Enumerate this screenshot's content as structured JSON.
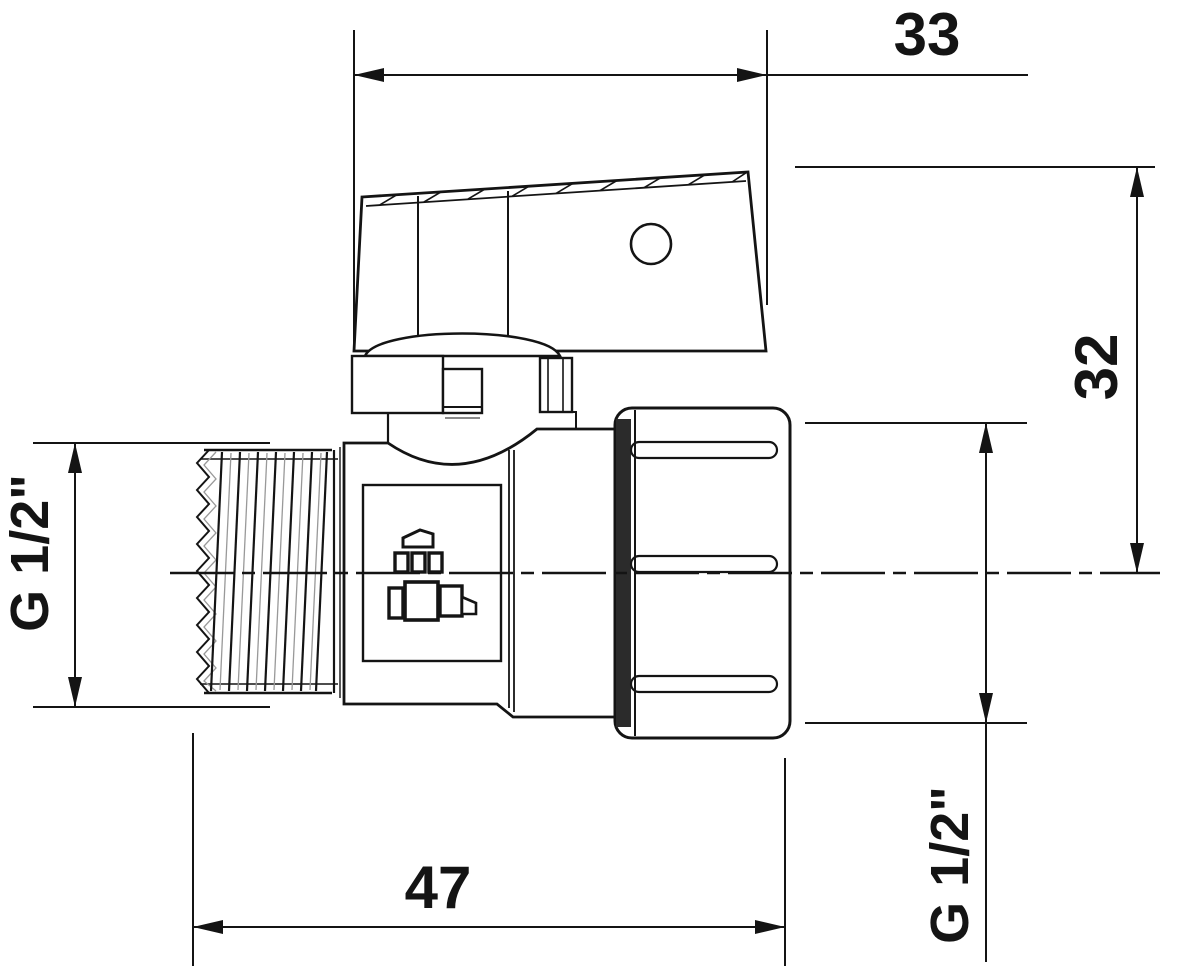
{
  "drawing": {
    "kind": "ball-valve-technical-drawing",
    "dimensions": {
      "handle_length": "33",
      "handle_height": "32",
      "overall_length": "47",
      "inlet_thread": "G 1/2\"",
      "outlet_thread": "G 1/2\""
    },
    "line_color": "#141414",
    "background": "#ffffff"
  }
}
